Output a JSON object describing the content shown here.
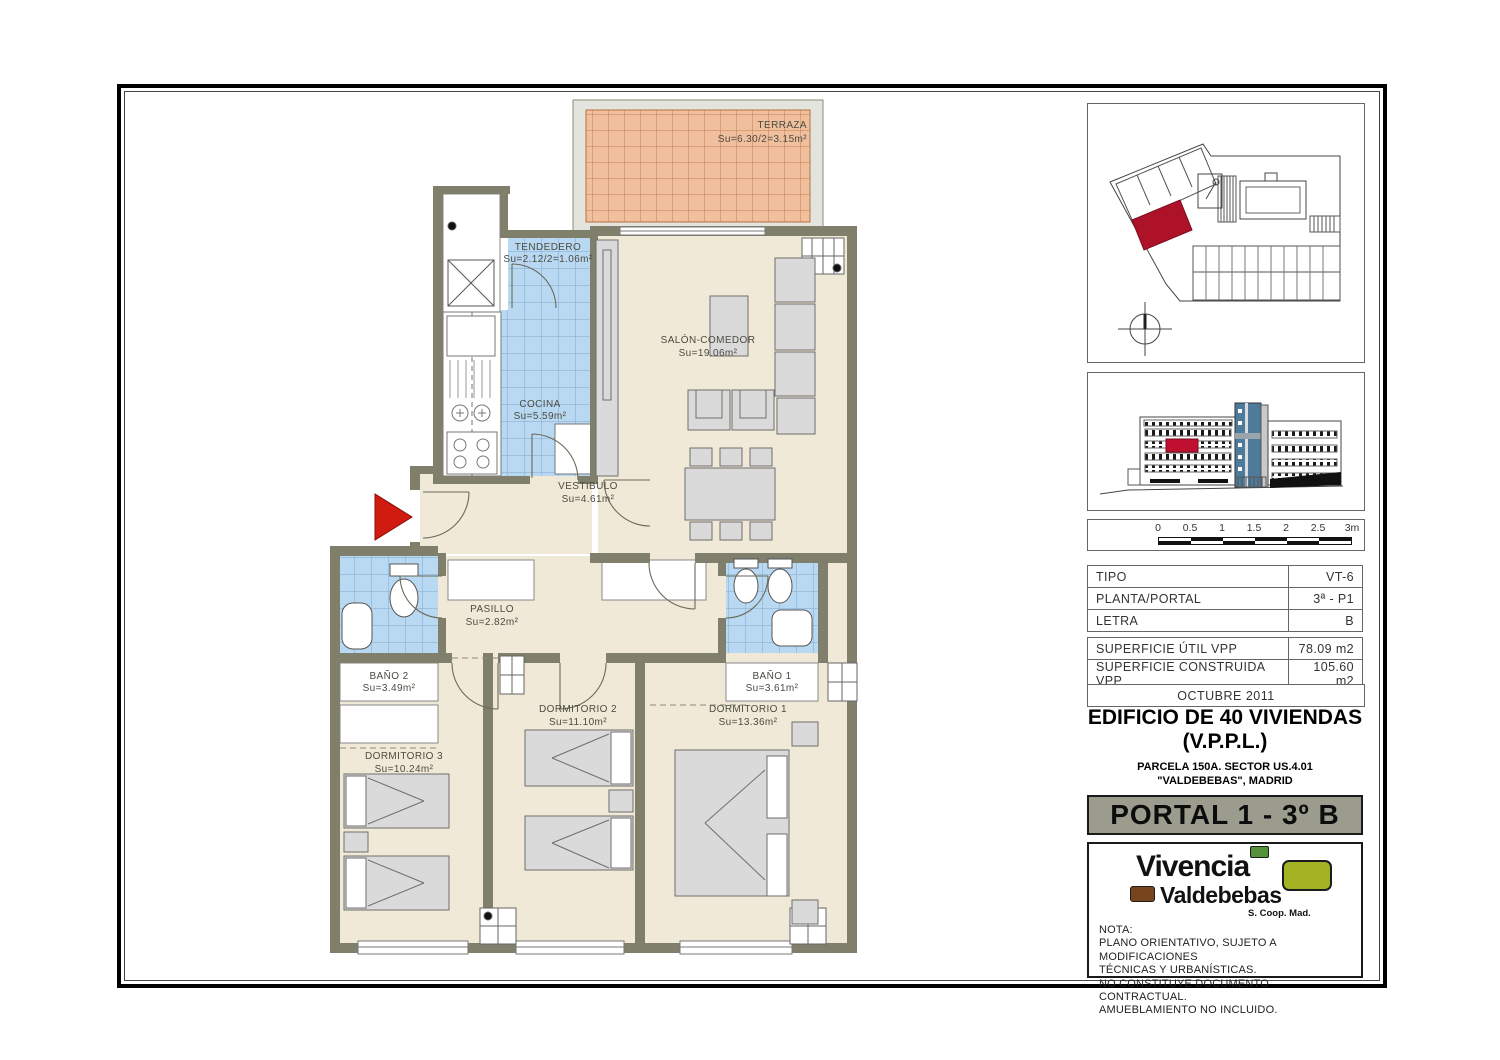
{
  "plan": {
    "rooms": [
      {
        "id": "terraza",
        "label": "TERRAZA",
        "area": "Su=6.30/2=3.15m²"
      },
      {
        "id": "tendedero",
        "label": "TENDEDERO",
        "area": "Su=2.12/2=1.06m²"
      },
      {
        "id": "cocina",
        "label": "COCINA",
        "area": "Su=5.59m²"
      },
      {
        "id": "salon",
        "label": "SALÓN-COMEDOR",
        "area": "Su=19.06m²"
      },
      {
        "id": "vestibulo",
        "label": "VESTIBULO",
        "area": "Su=4.61m²"
      },
      {
        "id": "pasillo",
        "label": "PASILLO",
        "area": "Su=2.82m²"
      },
      {
        "id": "bano2",
        "label": "BAÑO 2",
        "area": "Su=3.49m²"
      },
      {
        "id": "bano1",
        "label": "BAÑO 1",
        "area": "Su=3.61m²"
      },
      {
        "id": "dorm3",
        "label": "DORMITORIO 3",
        "area": "Su=10.24m²"
      },
      {
        "id": "dorm2",
        "label": "DORMITORIO 2",
        "area": "Su=11.10m²"
      },
      {
        "id": "dorm1",
        "label": "DORMITORIO 1",
        "area": "Su=13.36m²"
      }
    ]
  },
  "sidebar": {
    "scale_labels": [
      "0",
      "0.5",
      "1",
      "1.5",
      "2",
      "2.5",
      "3m"
    ],
    "spec_table": [
      {
        "label": "TIPO",
        "value": "VT-6"
      },
      {
        "label": "PLANTA/PORTAL",
        "value": "3ª - P1"
      },
      {
        "label": "LETRA",
        "value": "B"
      }
    ],
    "surface_table": [
      {
        "label": "SUPERFICIE ÚTIL VPP",
        "value": "78.09 m2"
      },
      {
        "label": "SUPERFICIE CONSTRUIDA VPP",
        "value": "105.60 m2"
      }
    ],
    "date": "OCTUBRE 2011",
    "title_line1": "EDIFICIO DE 40 VIVIENDAS",
    "title_line2": "(V.P.P.L.)",
    "subtitle_line1": "PARCELA 150A. SECTOR US.4.01",
    "subtitle_line2": "\"VALDEBEBAS\", MADRID",
    "banner": "PORTAL 1 - 3º B",
    "logo": {
      "line1": "Vivencia",
      "line2": "Valdebebas",
      "line3": "S. Coop. Mad."
    },
    "nota": [
      "NOTA:",
      "PLANO ORIENTATIVO, SUJETO A MODIFICACIONES",
      "TÉCNICAS Y URBANÍSTICAS.",
      "NO CONSTITUYE DOCUMENTO CONTRACTUAL.",
      "AMUEBLAMIENTO NO INCLUIDO."
    ]
  },
  "colors": {
    "wall": "#7f7f6b",
    "floor": "#f1e9d7",
    "tile_blue": "#b9d8f1",
    "tile_orange": "#efbf9e",
    "highlight_red": "#ae1228",
    "entrance_arrow": "#d11a10",
    "tower_blue": "#4e7a9c",
    "banner_grey": "#9c9c8e",
    "logo_olive": "#a3b324",
    "logo_green": "#56923c",
    "logo_brown": "#77451d"
  }
}
